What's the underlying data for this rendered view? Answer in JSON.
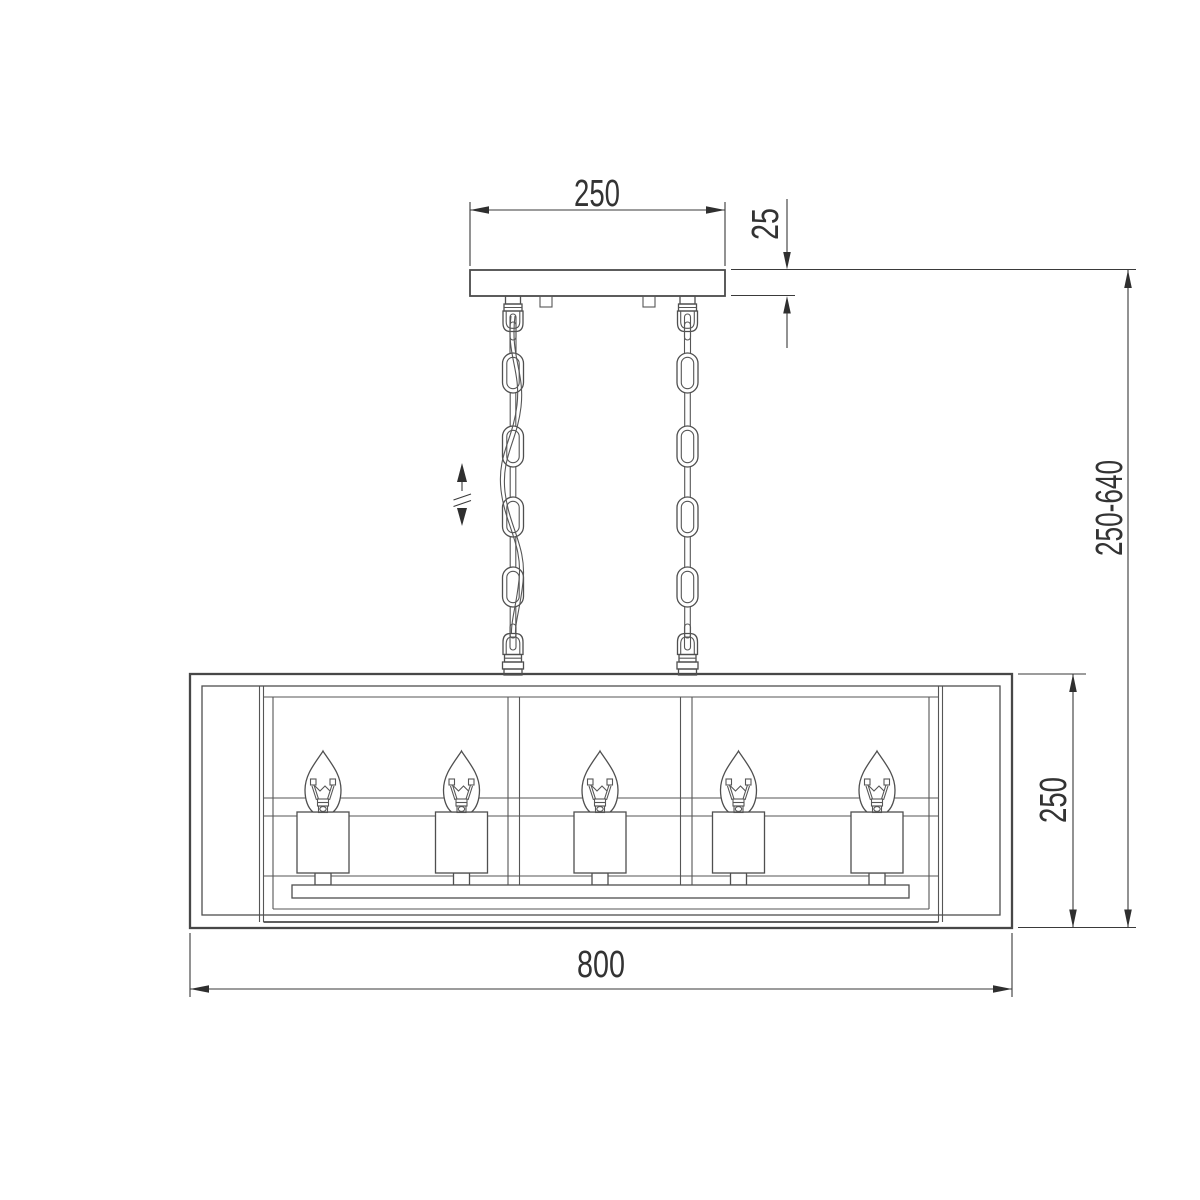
{
  "drawing": {
    "type": "technical dimension drawing, front view",
    "subject": "linear cage chandelier with ceiling plate, two suspension chains and five candle bulbs"
  },
  "dimensions": {
    "canopy_width": "250",
    "canopy_thickness": "25",
    "overall_height": "250-640",
    "body_height": "250",
    "body_width": "800"
  },
  "fixture": {
    "bulb_count": 5,
    "chain_count": 2,
    "oval_links_per_chain": 4,
    "height_adjustable": true
  },
  "colors": {
    "background": "#ffffff",
    "line": "#4f4f4f",
    "dimension_line": "#3a3a3a",
    "text": "#333333"
  }
}
